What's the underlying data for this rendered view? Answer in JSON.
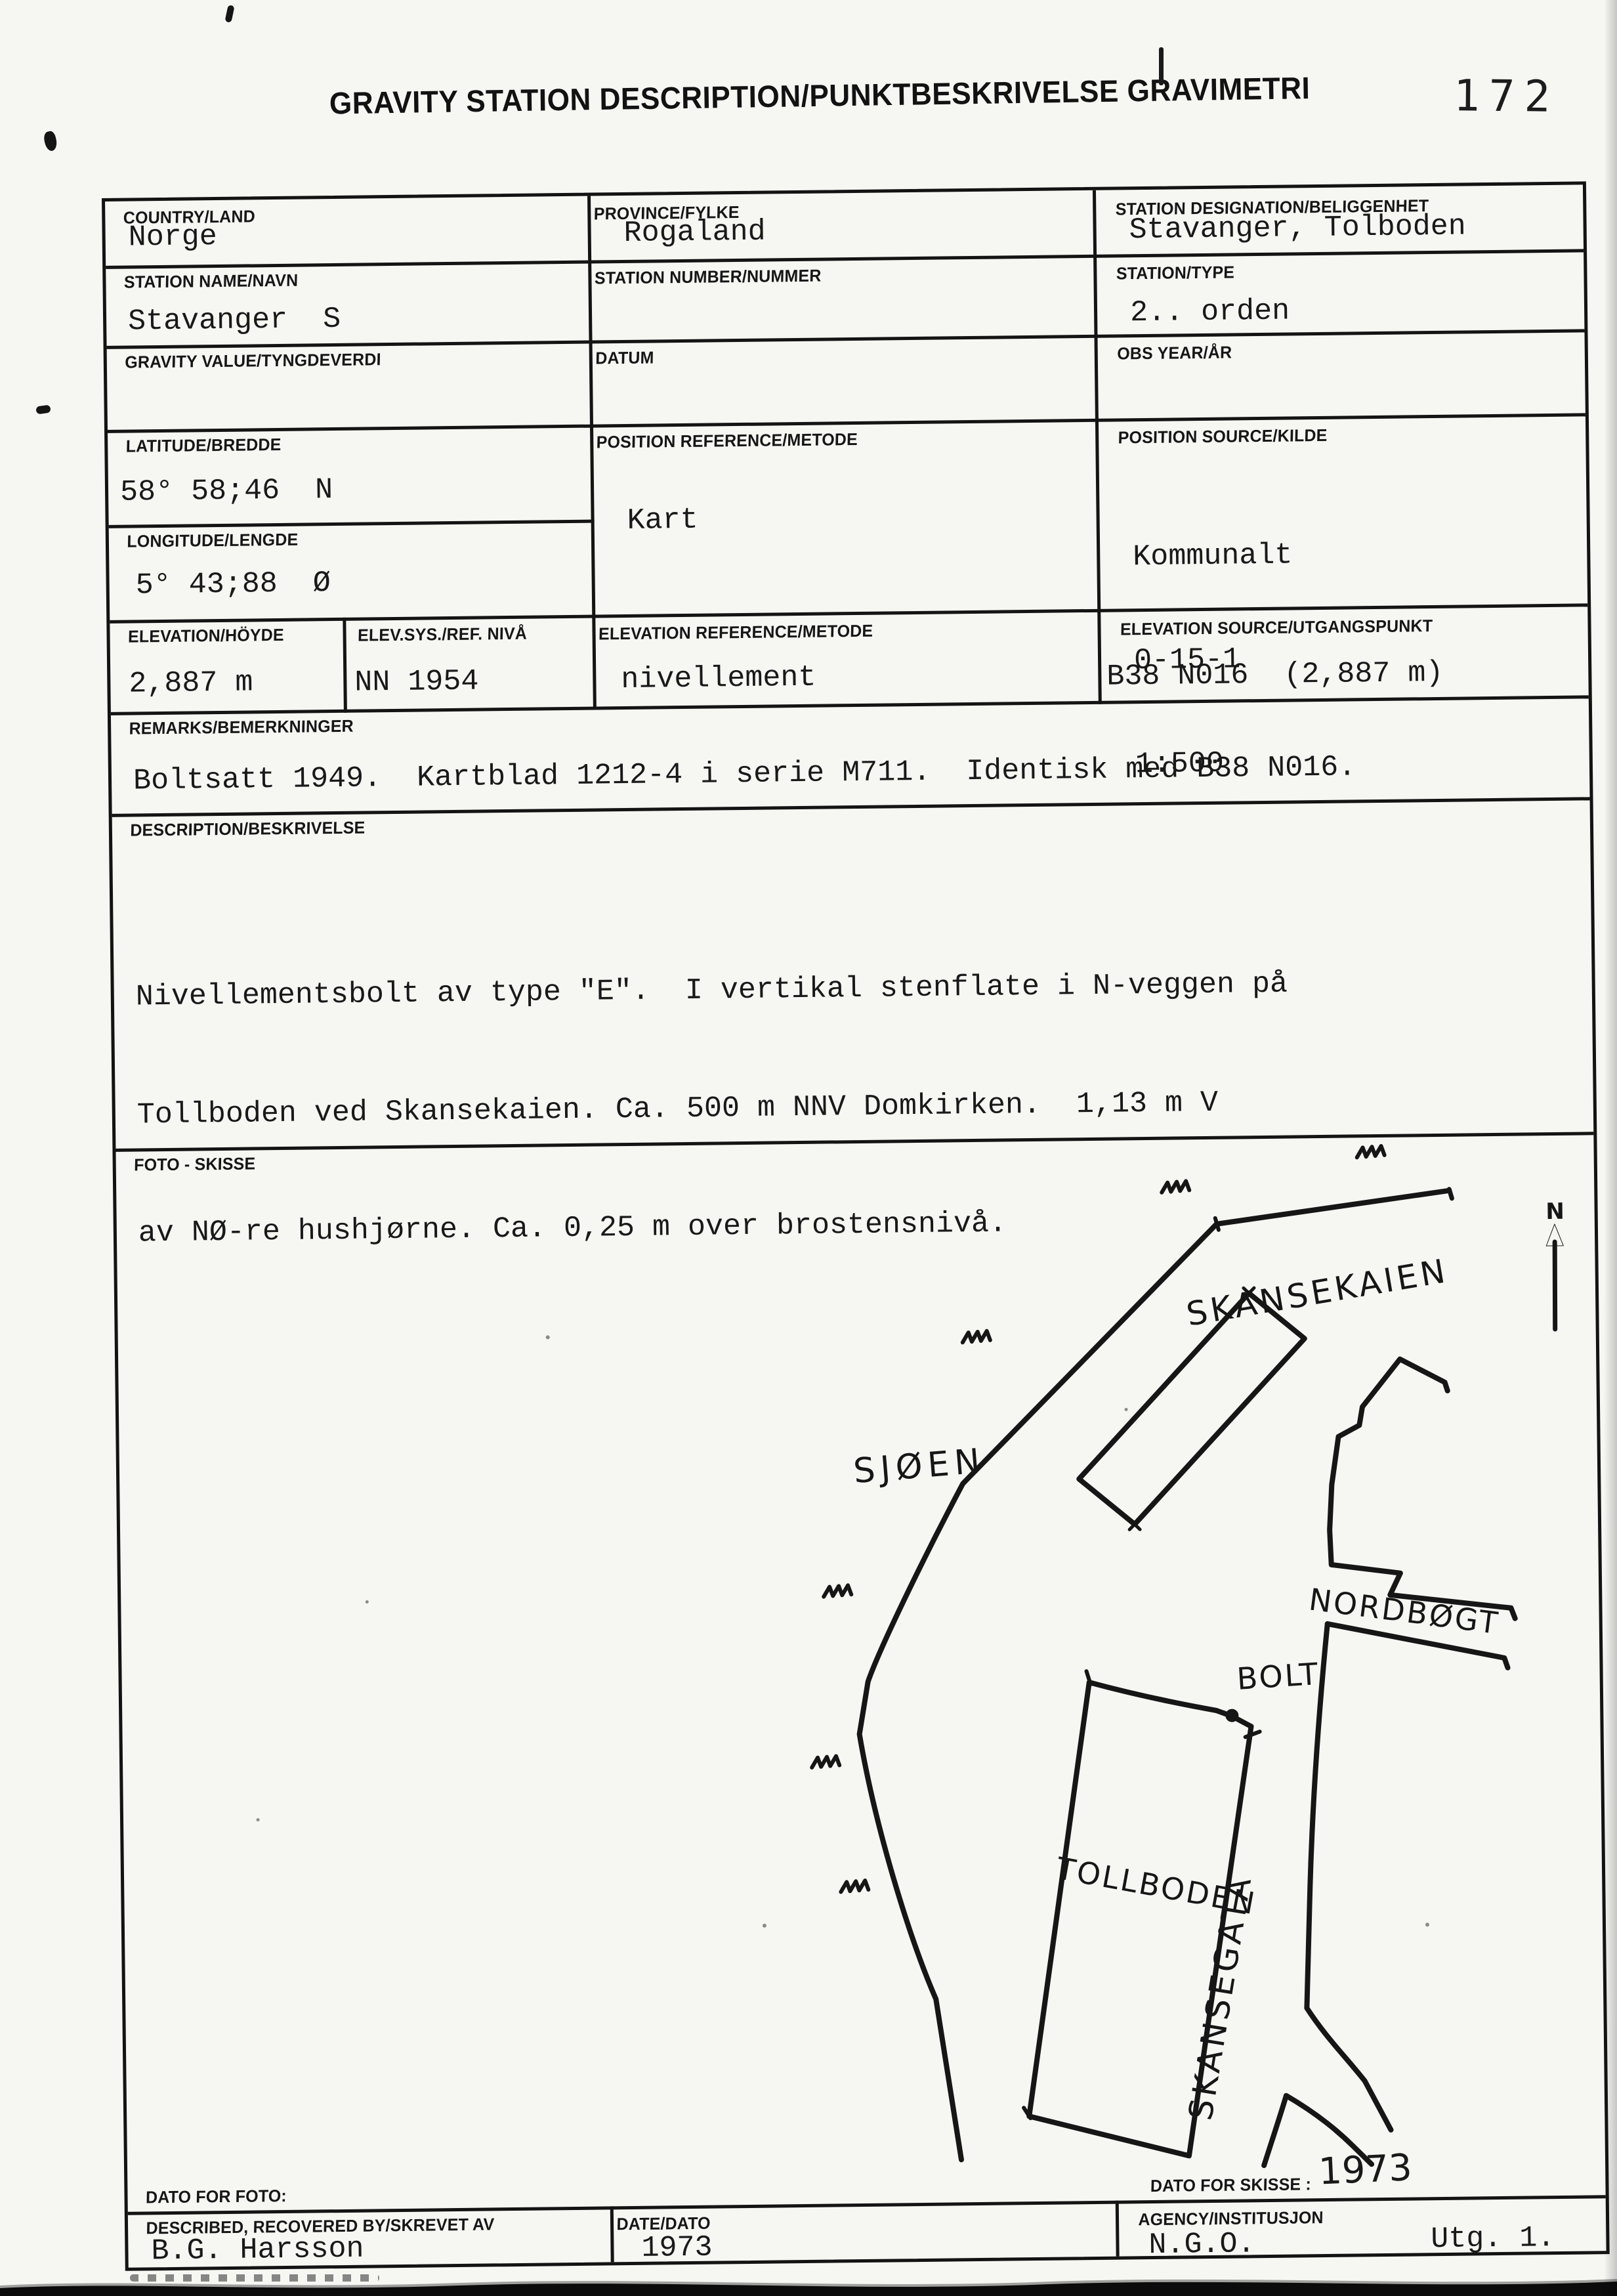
{
  "page": {
    "title": "GRAVITY STATION DESCRIPTION/PUNKTBESKRIVELSE GRAVIMETRI",
    "page_number": "172"
  },
  "colors": {
    "ink": "#161616",
    "paper": "#f6f6f3"
  },
  "fields": {
    "country": {
      "label": "COUNTRY/LAND",
      "value": "Norge"
    },
    "province": {
      "label": "PROVINCE/FYLKE",
      "value": "Rogaland"
    },
    "designation": {
      "label": "STATION DESIGNATION/BELIGGENHET",
      "value": "Stavanger, Tolboden"
    },
    "station_name": {
      "label": "STATION NAME/NAVN",
      "value": "Stavanger  S"
    },
    "station_number": {
      "label": "STATION NUMBER/NUMMER",
      "value": ""
    },
    "station_type": {
      "label": "STATION/TYPE",
      "value": "2.. orden"
    },
    "gravity_value": {
      "label": "GRAVITY VALUE/TYNGDEVERDI",
      "value": ""
    },
    "datum": {
      "label": "DATUM",
      "value": ""
    },
    "obs_year": {
      "label": "OBS YEAR/ÅR",
      "value": ""
    },
    "latitude": {
      "label": "LATITUDE/BREDDE",
      "value": "58° 58;46  N"
    },
    "longitude": {
      "label": "LONGITUDE/LENGDE",
      "value": "5° 43;88  Ø"
    },
    "position_reference": {
      "label": "POSITION REFERENCE/METODE",
      "value": "Kart"
    },
    "position_source": {
      "label": "POSITION SOURCE/KILDE",
      "lines": [
        "Kommunalt",
        "0-15-1",
        "1:500"
      ]
    },
    "elevation": {
      "label": "ELEVATION/HÖYDE",
      "value": "2,887 m"
    },
    "elev_sys": {
      "label": "ELEV.SYS./REF. NIVÅ",
      "value": "NN 1954"
    },
    "elevation_reference": {
      "label": "ELEVATION REFERENCE/METODE",
      "value": "nivellement"
    },
    "elevation_source": {
      "label": "ELEVATION SOURCE/UTGANGSPUNKT",
      "value": "B38 N016  (2,887 m)"
    },
    "remarks": {
      "label": "REMARKS/BEMERKNINGER",
      "value": "Boltsatt 1949.  Kartblad 1212-4 i serie M711.  Identisk med B38 N016."
    },
    "description": {
      "label": "DESCRIPTION/BESKRIVELSE",
      "lines": [
        "Nivellementsbolt av type \"E\".  I vertikal stenflate i N-veggen på",
        "Tollboden ved Skansekaien. Ca. 500 m NNV Domkirken.  1,13 m V",
        "av NØ-re hushjørne. Ca. 0,25 m over brostensnivå."
      ]
    },
    "foto": {
      "label": "FOTO - SKISSE"
    },
    "dato_foto": {
      "label": "DATO FOR FOTO:",
      "value": ""
    },
    "dato_skisse": {
      "label": "DATO FOR SKISSE :",
      "value": "1973"
    },
    "described_by": {
      "label": "DESCRIBED, RECOVERED BY/SKREVET AV",
      "value": "B.G. Harsson"
    },
    "date": {
      "label": "DATE/DATO",
      "value": "1973"
    },
    "agency": {
      "label": "AGENCY/INSTITUSJON",
      "value": "N.G.O.",
      "value2": "Utg. 1."
    }
  },
  "sketch": {
    "labels": {
      "skansekaien": "SKANSEKAIEN",
      "sjoen": "SJØEN",
      "bolt": "BOLT",
      "nordbogt": "NORDBØGT",
      "tollboden": "TOLLBODEN",
      "skansegata": "SKANSEGATA",
      "north": "N"
    }
  }
}
